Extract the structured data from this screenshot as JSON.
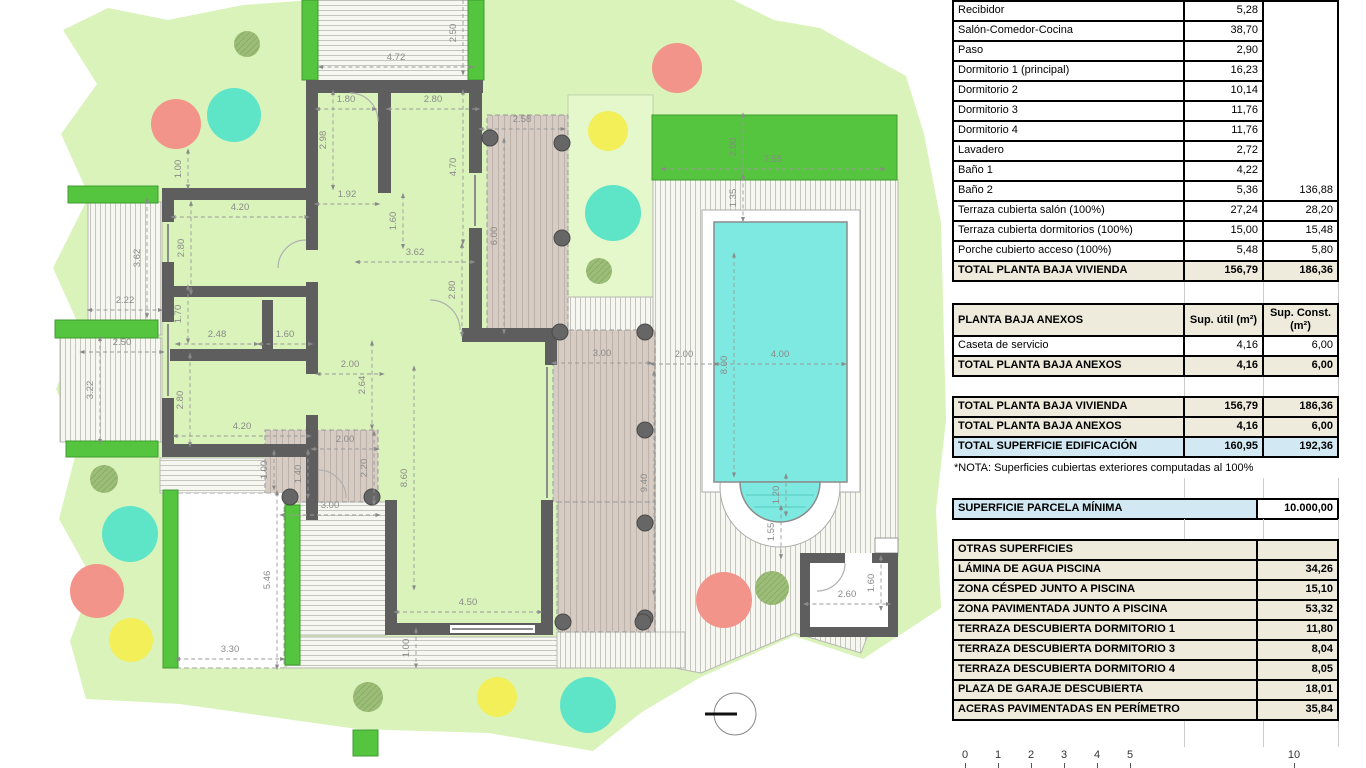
{
  "plan": {
    "colors": {
      "grass": "#daf3ba",
      "garden": "#e4f8cc",
      "green": "#55c43e",
      "green_stroke": "#3f9c30",
      "wall": "#5e5e5e",
      "pool_water": "#7de9e0",
      "deck": "#d6ccc3",
      "column": "#666666",
      "dim_text": "#8a8a8a",
      "red_tree": "#f29489",
      "cyan_tree": "#5ee5c8",
      "yellow_tree": "#f2ef59",
      "olive_tree": "#9cbd78"
    },
    "dimensions": [
      [
        "2.50",
        456,
        33,
        1
      ],
      [
        "4.72",
        396,
        60,
        0
      ],
      [
        "1.80",
        346,
        102,
        0
      ],
      [
        "2.80",
        433,
        102,
        0
      ],
      [
        "2.98",
        326,
        140,
        1
      ],
      [
        "4.70",
        456,
        167,
        1
      ],
      [
        "1.92",
        347,
        197,
        0
      ],
      [
        "1.60",
        396,
        221,
        1
      ],
      [
        "1.00",
        181,
        169,
        1
      ],
      [
        "4.20",
        240,
        210,
        0
      ],
      [
        "2.80",
        184,
        248,
        1
      ],
      [
        "3.62",
        415,
        255,
        0
      ],
      [
        "2.80",
        455,
        290,
        1
      ],
      [
        "2.58",
        522,
        122,
        0
      ],
      [
        "6.00",
        497,
        236,
        1
      ],
      [
        "3.62",
        140,
        258,
        1
      ],
      [
        "2.22",
        125,
        303,
        0
      ],
      [
        "1.70",
        181,
        314,
        1
      ],
      [
        "2.48",
        217,
        337,
        0
      ],
      [
        "1.60",
        285,
        337,
        0
      ],
      [
        "2.50",
        122,
        345,
        0
      ],
      [
        "3.22",
        93,
        390,
        1
      ],
      [
        "2.80",
        183,
        400,
        1
      ],
      [
        "4.20",
        242,
        429,
        0
      ],
      [
        "2.00",
        350,
        367,
        0
      ],
      [
        "2.64",
        365,
        385,
        1
      ],
      [
        "2.00",
        345,
        442,
        0
      ],
      [
        "1.00",
        267,
        470,
        1
      ],
      [
        "1.40",
        301,
        474,
        1
      ],
      [
        "2.20",
        367,
        468,
        1
      ],
      [
        "8.60",
        407,
        478,
        1
      ],
      [
        "3.00",
        330,
        508,
        0
      ],
      [
        "5.46",
        270,
        580,
        1
      ],
      [
        "3.30",
        230,
        652,
        0
      ],
      [
        "4.50",
        468,
        605,
        0
      ],
      [
        "1.00",
        409,
        648,
        1
      ],
      [
        "3.00",
        602,
        356,
        0
      ],
      [
        "2.00",
        684,
        357,
        0
      ],
      [
        "4.00",
        780,
        357,
        0
      ],
      [
        "8.00",
        727,
        365,
        1
      ],
      [
        "9.40",
        647,
        483,
        1
      ],
      [
        "2.00",
        736,
        147,
        1
      ],
      [
        "7.55",
        773,
        162,
        0
      ],
      [
        "1.35",
        736,
        198,
        1
      ],
      [
        "1.20",
        779,
        495,
        1
      ],
      [
        "1.55",
        774,
        532,
        1
      ],
      [
        "2.60",
        847,
        597,
        0
      ],
      [
        "1.60",
        874,
        583,
        1
      ]
    ],
    "trees": [
      [
        "olive",
        247,
        44,
        13
      ],
      [
        "red",
        176,
        124,
        25
      ],
      [
        "cyan",
        234,
        115,
        27
      ],
      [
        "red",
        677,
        68,
        25
      ],
      [
        "yellow",
        608,
        131,
        20
      ],
      [
        "cyan",
        613,
        213,
        28
      ],
      [
        "olive",
        599,
        271,
        13
      ],
      [
        "olive",
        104,
        479,
        14
      ],
      [
        "cyan",
        130,
        534,
        28
      ],
      [
        "red",
        97,
        591,
        27
      ],
      [
        "yellow",
        131,
        640,
        22
      ],
      [
        "olive",
        368,
        697,
        15
      ],
      [
        "yellow",
        497,
        697,
        20
      ],
      [
        "cyan",
        588,
        705,
        28
      ],
      [
        "red",
        724,
        600,
        28
      ],
      [
        "olive",
        772,
        588,
        17
      ]
    ],
    "columns": [
      [
        490,
        138
      ],
      [
        562,
        143
      ],
      [
        562,
        238
      ],
      [
        560,
        332
      ],
      [
        645,
        332
      ],
      [
        645,
        430
      ],
      [
        645,
        523
      ],
      [
        645,
        618
      ],
      [
        290,
        497
      ],
      [
        372,
        497
      ],
      [
        563,
        622
      ],
      [
        643,
        622
      ]
    ],
    "scale_bar": {
      "labels": [
        [
          "0",
          965
        ],
        [
          "1",
          998
        ],
        [
          "2",
          1031
        ],
        [
          "3",
          1064
        ],
        [
          "4",
          1097
        ],
        [
          "5",
          1130
        ],
        [
          "10",
          1294
        ]
      ]
    }
  },
  "tables": {
    "main": {
      "rows": [
        {
          "l": "Recibidor",
          "a": "5,28"
        },
        {
          "l": "Salón-Comedor-Cocina",
          "a": "38,70"
        },
        {
          "l": "Paso",
          "a": "2,90"
        },
        {
          "l": "Dormitorio 1 (principal)",
          "a": "16,23"
        },
        {
          "l": "Dormitorio 2",
          "a": "10,14"
        },
        {
          "l": "Dormitorio 3",
          "a": "11,76"
        },
        {
          "l": "Dormitorio 4",
          "a": "11,76"
        },
        {
          "l": "Lavadero",
          "a": "2,72"
        },
        {
          "l": "Baño 1",
          "a": "4,22"
        },
        {
          "l": "Baño 2",
          "a": "5,36",
          "b": "136,88"
        },
        {
          "l": "Terraza cubierta salón (100%)",
          "a": "27,24",
          "b": "28,20"
        },
        {
          "l": "Terraza cubierta dormitorios (100%)",
          "a": "15,00",
          "b": "15,48"
        },
        {
          "l": "Porche cubierto acceso (100%)",
          "a": "5,48",
          "b": "5,80"
        },
        {
          "l": "TOTAL PLANTA BAJA VIVIENDA",
          "a": "156,79",
          "b": "186,36",
          "total": true
        }
      ]
    },
    "anexos": {
      "header": {
        "l": "PLANTA BAJA ANEXOS",
        "a": "Sup. útil (m²)",
        "b": "Sup. Const. (m²)"
      },
      "rows": [
        {
          "l": "Caseta de servicio",
          "a": "4,16",
          "b": "6,00"
        },
        {
          "l": "TOTAL PLANTA BAJA ANEXOS",
          "a": "4,16",
          "b": "6,00",
          "total": true
        }
      ]
    },
    "totals": {
      "rows": [
        {
          "l": "TOTAL PLANTA BAJA VIVIENDA",
          "a": "156,79",
          "b": "186,36",
          "total": true
        },
        {
          "l": "TOTAL PLANTA BAJA ANEXOS",
          "a": "4,16",
          "b": "6,00",
          "total": true
        },
        {
          "l": "TOTAL SUPERFICIE EDIFICACIÓN",
          "a": "160,95",
          "b": "192,36",
          "total": true,
          "blue": true
        }
      ],
      "note": "*NOTA: Superficies cubiertas exteriores computadas al 100%"
    },
    "parcela": {
      "label": "SUPERFICIE PARCELA MÍNIMA",
      "value": "10.000,00"
    },
    "otras": {
      "header": "OTRAS SUPERFICIES",
      "rows": [
        {
          "l": "LÁMINA DE AGUA PISCINA",
          "v": "34,26"
        },
        {
          "l": "ZONA CÉSPED JUNTO A PISCINA",
          "v": "15,10"
        },
        {
          "l": "ZONA PAVIMENTADA JUNTO A PISCINA",
          "v": "53,32"
        },
        {
          "l": "TERRAZA DESCUBIERTA DORMITORIO 1",
          "v": "11,80"
        },
        {
          "l": "TERRAZA DESCUBIERTA DORMITORIO 3",
          "v": "8,04"
        },
        {
          "l": "TERRAZA DESCUBIERTA DORMITORIO 4",
          "v": "8,05"
        },
        {
          "l": "PLAZA DE GARAJE DESCUBIERTA",
          "v": "18,01"
        },
        {
          "l": "ACERAS PAVIMENTADAS EN PERÍMETRO",
          "v": "35,84"
        }
      ]
    }
  }
}
